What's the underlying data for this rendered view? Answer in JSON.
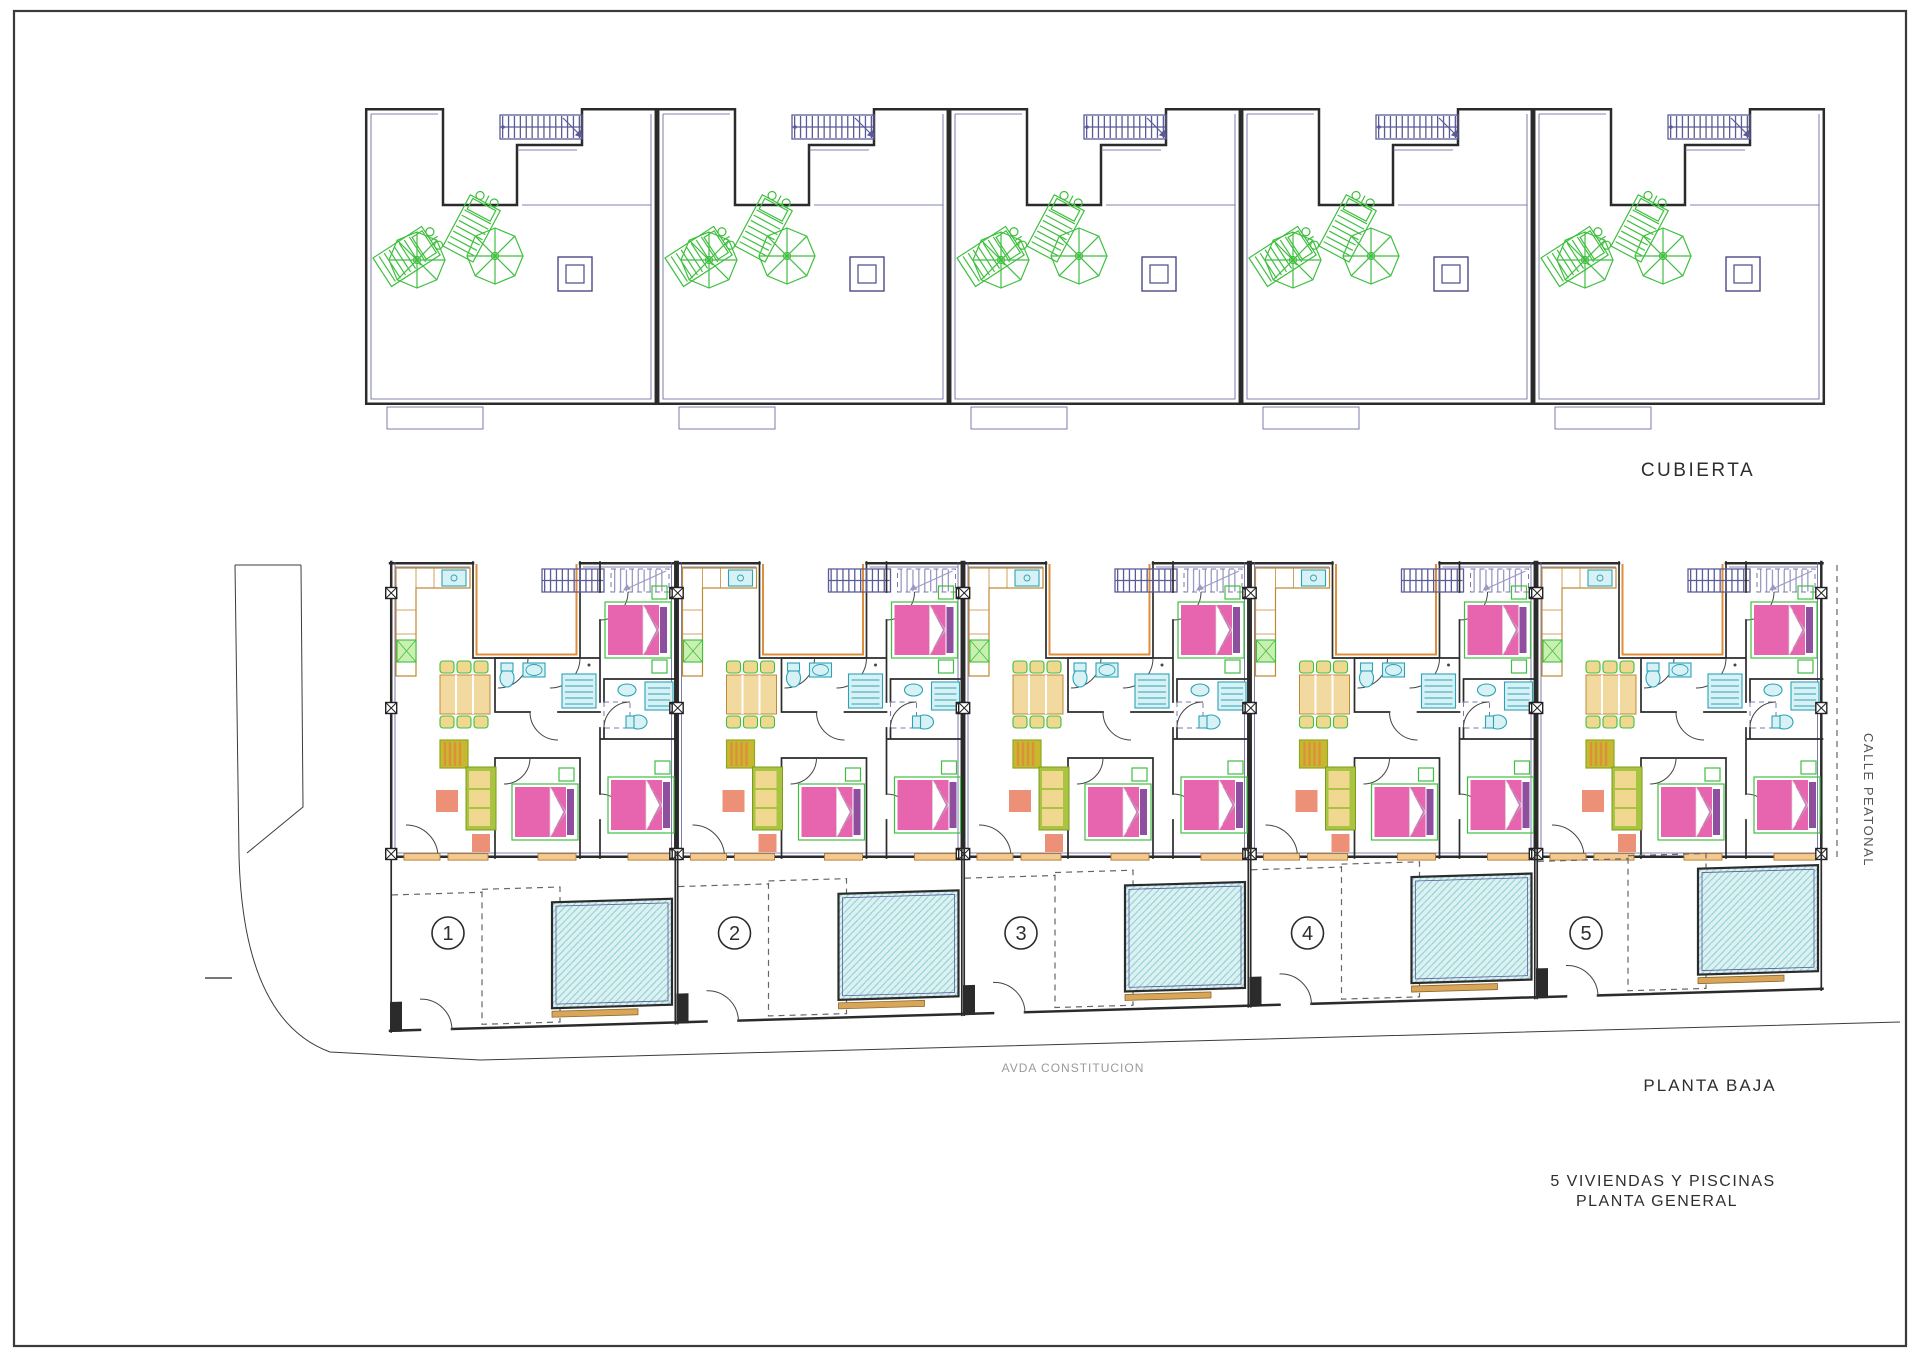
{
  "drawing": {
    "roof_plan": {
      "label": "CUBIERTA",
      "unit_count": 5
    },
    "ground_plan": {
      "label": "PLANTA BAJA",
      "unit_numbers": [
        "1",
        "2",
        "3",
        "4",
        "5"
      ]
    },
    "streets": {
      "right_vertical": "CALLE PEATONAL",
      "bottom": "AVDA CONSTITUCION"
    },
    "title": {
      "line1": "5 VIVIENDAS Y PISCINAS",
      "line2": "PLANTA GENERAL"
    }
  },
  "colors": {
    "walls": "#2b2b2b",
    "blue": "#5b5b99",
    "grn": "#3fbf3f",
    "pink": "#e765ae",
    "purple": "#8f4f9f",
    "bedgrn": "#7cc45c",
    "tan": "#f2d9a0",
    "orange": "#de8f3c",
    "salmon": "#ec9077",
    "cyan": "#2aa3b8",
    "cyanfill": "#d8f1f4",
    "poolfill": "#dcf1f2",
    "poolhatch": "#8fcfd2",
    "sofagrn": "#a9c440",
    "cush": "#f0d890"
  }
}
